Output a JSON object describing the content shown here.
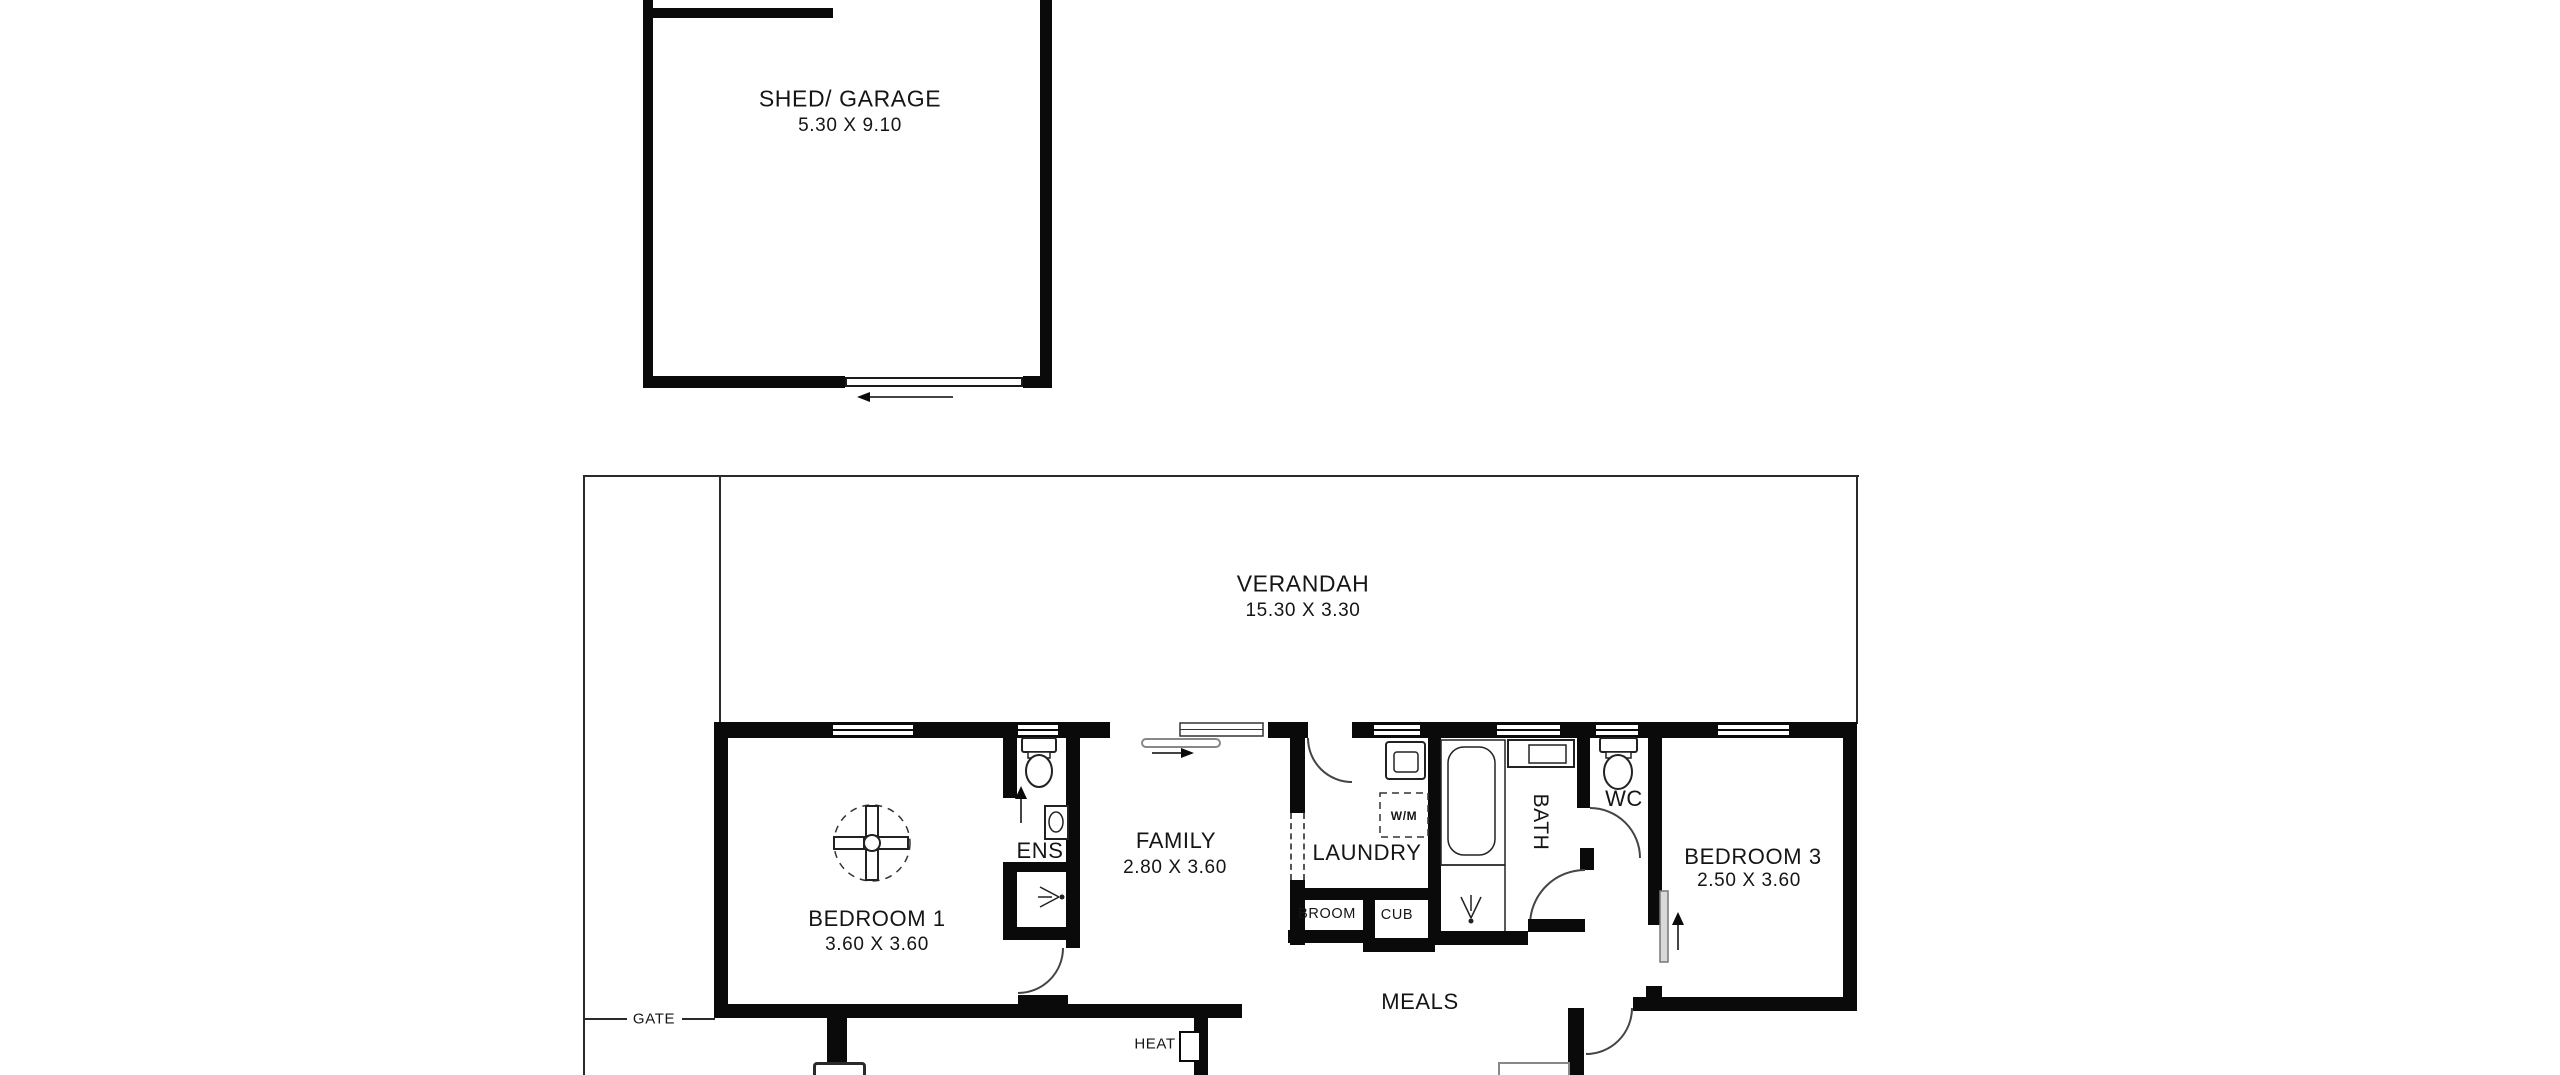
{
  "colors": {
    "wall": "#0a0a0a",
    "background": "#ffffff",
    "thin_line": "#2a2a2a",
    "slider_panel": "#d9d9d9"
  },
  "plan": {
    "shed": {
      "name": "SHED/ GARAGE",
      "dims": "5.30 X 9.10"
    },
    "verandah": {
      "name": "VERANDAH",
      "dims": "15.30 X 3.30"
    },
    "bedroom1": {
      "name": "BEDROOM 1",
      "dims": "3.60 X 3.60"
    },
    "ens": {
      "name": "ENS"
    },
    "family": {
      "name": "FAMILY",
      "dims": "2.80 X 3.60"
    },
    "laundry": {
      "name": "LAUNDRY"
    },
    "washing_machine": {
      "name": "W/M"
    },
    "broom": {
      "name": "BROOM"
    },
    "cub": {
      "name": "CUB"
    },
    "bath": {
      "name": "BATH"
    },
    "wc": {
      "name": "WC"
    },
    "bedroom3": {
      "name": "BEDROOM 3",
      "dims": "2.50 X 3.60"
    },
    "meals": {
      "name": "MEALS"
    },
    "heat": {
      "name": "HEAT"
    },
    "gate": {
      "name": "GATE"
    }
  }
}
